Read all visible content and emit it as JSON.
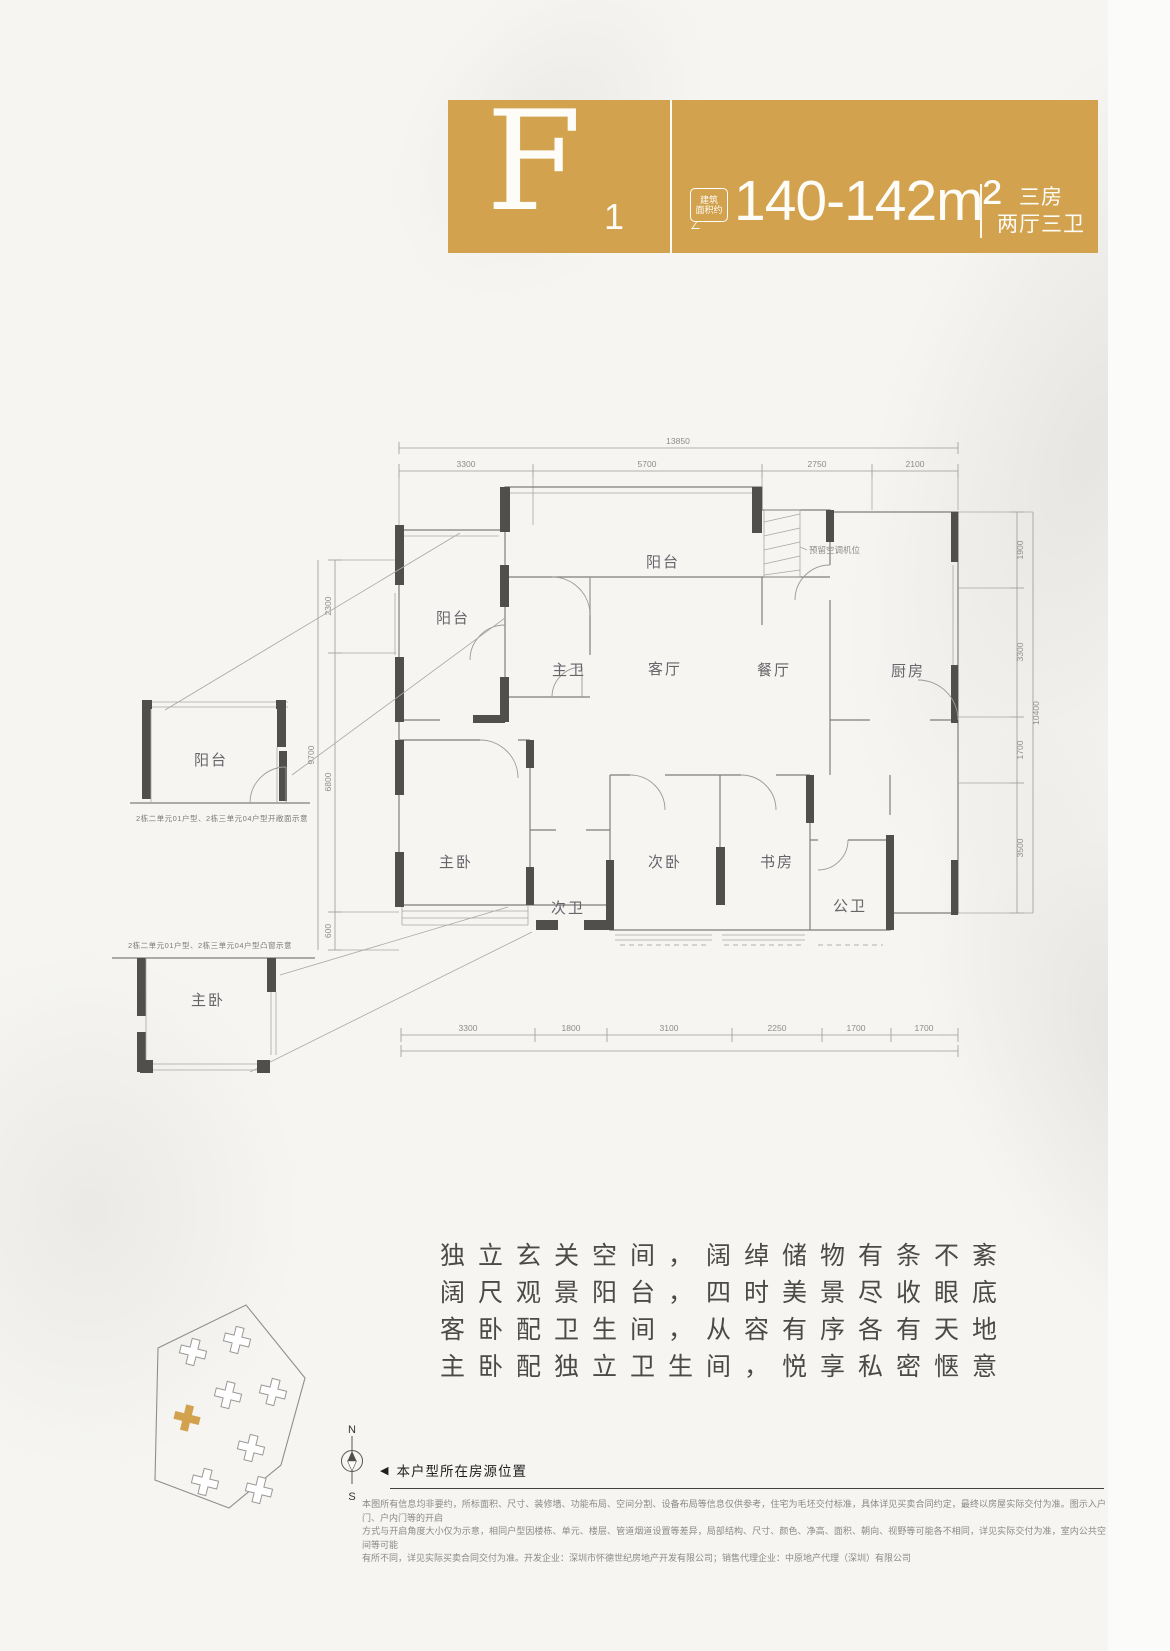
{
  "colors": {
    "accent": "#d2a24e",
    "wall": "#514f4c",
    "line": "#8b8a87"
  },
  "header": {
    "type_letter": "F",
    "type_sub": "1",
    "badge_line1": "建筑",
    "badge_line2": "面积约",
    "area_value": "140-142m²",
    "spec_line1": "三房",
    "spec_line2": "两厅三卫"
  },
  "plan": {
    "rooms": {
      "balcony_top": "阳台",
      "balcony_left": "阳台",
      "master_bath": "主卫",
      "living": "客厅",
      "dining": "餐厅",
      "kitchen": "厨房",
      "master_bed": "主卧",
      "second_bath": "次卫",
      "second_bed": "次卧",
      "study": "书房",
      "public_bath": "公卫"
    },
    "ac_note": "预留空调机位",
    "dims": {
      "top_total": "13850",
      "top": [
        "3300",
        "5700",
        "2750",
        "2100"
      ],
      "bottom": [
        "3300",
        "1800",
        "3100",
        "2250",
        "1700",
        "1700"
      ],
      "left": [
        "2300",
        "6800",
        "600"
      ],
      "left_total": "9700",
      "right": [
        "1900",
        "3300",
        "1700",
        "3500"
      ],
      "right_total": "10400"
    },
    "detail_balcony": {
      "room": "阳台",
      "caption": "2栋二单元01户型、2栋三单元04户型开敞面示意"
    },
    "detail_baywindow": {
      "room": "主卧",
      "caption": "2栋二单元01户型、2栋三单元04户型凸窗示意"
    }
  },
  "description": {
    "line1": "独立玄关空间，阔绰储物有条不紊",
    "line2": "阔尺观景阳台，四时美景尽收眼底",
    "line3": "客卧配卫生间，从容有序各有天地",
    "line4": "主卧配独立卫生间，悦享私密惬意"
  },
  "footer": {
    "compass_n": "N",
    "compass_s": "S",
    "marker": "◀",
    "location_label": "本户型所在房源位置",
    "disclaimer1": "本图所有信息均非要约，所标面积、尺寸、装修墙、功能布局、空间分割、设备布局等信息仅供参考，住宅为毛坯交付标准，具体详见买卖合同约定，最终以房屋实际交付为准。图示入户门、户内门等的开启",
    "disclaimer2": "方式与开启角度大小仅为示意，相同户型因楼栋、单元、楼层、管道烟道设置等差异，局部结构、尺寸、颜色、净高、面积、朝向、视野等可能各不相同，详见实际交付为准，室内公共空间等可能",
    "disclaimer3": "有所不同，详见实际买卖合同交付为准。开发企业：深圳市怀德世纪房地产开发有限公司；销售代理企业：中原地产代理（深圳）有限公司"
  }
}
